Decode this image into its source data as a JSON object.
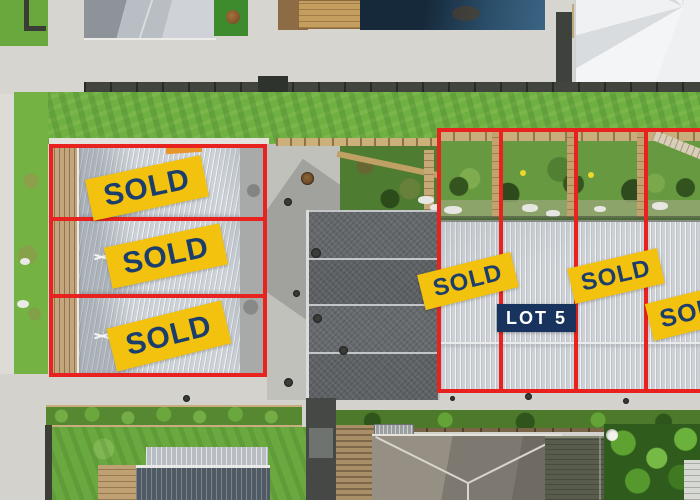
{
  "image": {
    "kind": "aerial-drone-photograph",
    "subject": "townhouse development site with surveyed lots marked in red"
  },
  "overlay": {
    "colors": {
      "red": "#e8231f",
      "yellow": "#f3c20e",
      "navy": "#1c3e6d",
      "lot5bg": "#17335e",
      "lot5text": "#ffffff"
    },
    "sold_badges": [
      {
        "label": "SOLD"
      },
      {
        "label": "SOLD"
      },
      {
        "label": "SOLD"
      },
      {
        "label": "SOLD"
      },
      {
        "label": "SOLD"
      },
      {
        "label": "SOLD"
      }
    ],
    "lot5_badge": {
      "label": "LOT 5"
    }
  }
}
